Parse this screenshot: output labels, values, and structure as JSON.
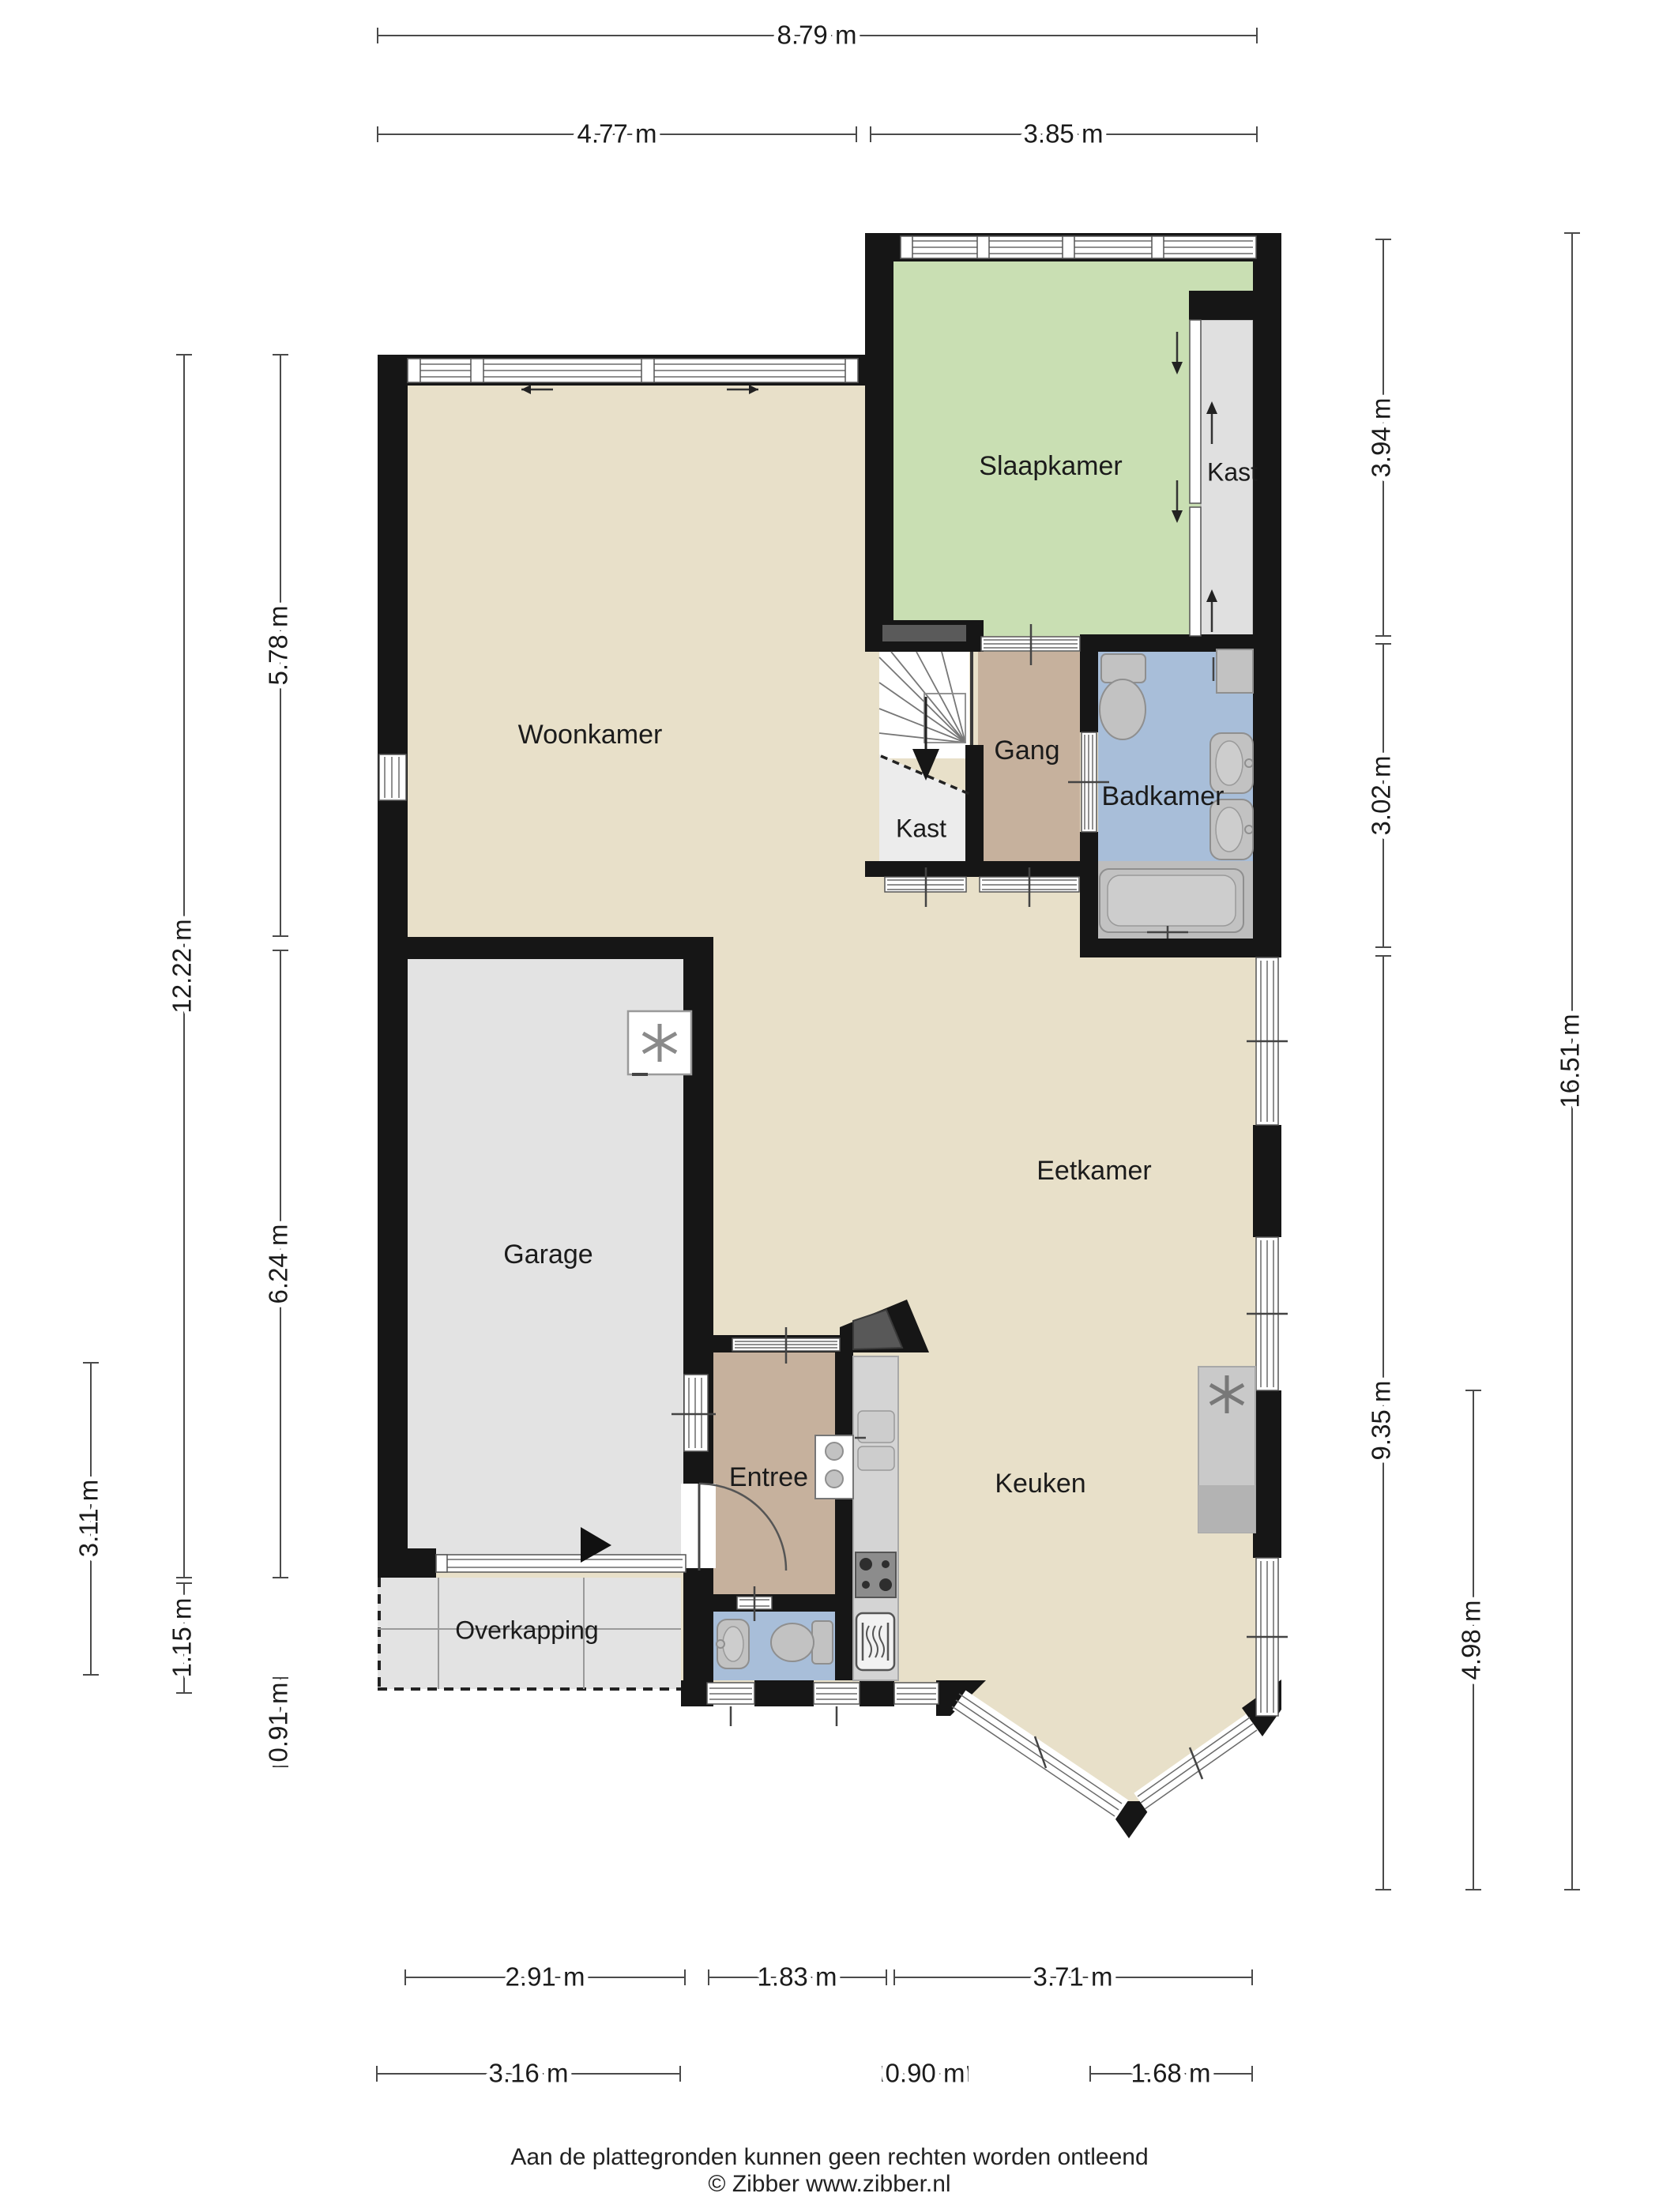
{
  "rooms": {
    "woonkamer": "Woonkamer",
    "slaapkamer": "Slaapkamer",
    "kast_bedroom": "Kast",
    "gang": "Gang",
    "kast_stairs": "Kast",
    "badkamer": "Badkamer",
    "garage": "Garage",
    "eetkamer": "Eetkamer",
    "entree": "Entree",
    "keuken": "Keuken",
    "overkapping": "Overkapping"
  },
  "dimensions": {
    "top_total": "8.79 m",
    "top_left": "4.77 m",
    "top_right": "3.85 m",
    "left_outer": "3.11 m",
    "left_mid_total": "12.22 m",
    "left_mid_lower": "1.15 m",
    "left_inner_top": "5.78 m",
    "left_inner_bottom": "6.24 m",
    "left_inner_lowest": "0.91 m",
    "right_inner_top": "3.94 m",
    "right_inner_mid": "3.02 m",
    "right_inner_bottom": "9.35 m",
    "right_mid": "4.98 m",
    "right_outer": "16.51 m",
    "bottom_row1_left": "2.91 m",
    "bottom_row1_mid": "1.83 m",
    "bottom_row1_right": "3.71 m",
    "bottom_row2_left": "3.16 m",
    "bottom_row2_mid": "0.90 m",
    "bottom_row2_right": "1.68 m"
  },
  "footer": {
    "disclaimer": "Aan de plattegronden kunnen geen rechten worden ontleend",
    "credit": "© Zibber www.zibber.nl"
  },
  "colors": {
    "floor_main": "#e8e0c9",
    "bedroom_green": "#c9dfb3",
    "hall_brown": "#c6b19d",
    "bath_blue": "#a8bed9",
    "garage_gray": "#e3e3e3",
    "closet_gray": "#e9e9e9",
    "counter_gray": "#d4d4d4",
    "wall_black": "#161616"
  }
}
